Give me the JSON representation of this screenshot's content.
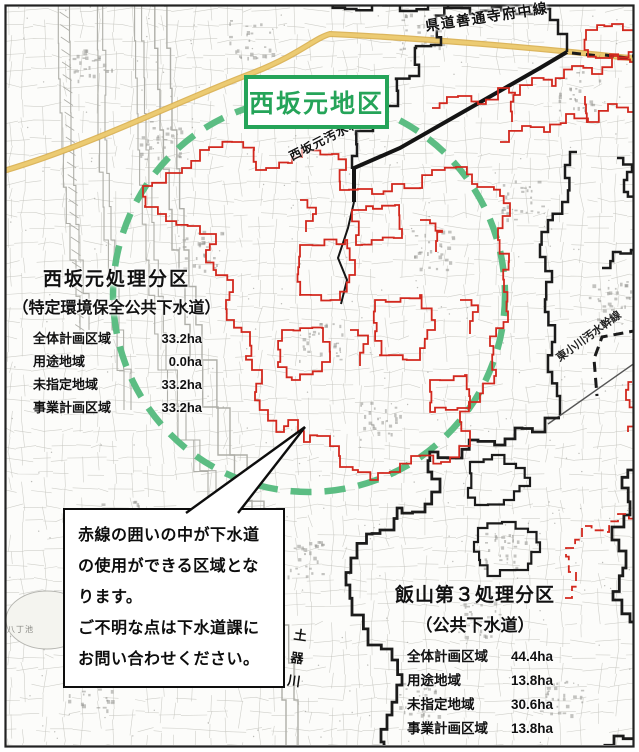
{
  "title_box": {
    "label": "西坂元地区"
  },
  "labels": {
    "road_top": "県道善通寺府中線",
    "trunk_sewer": "西坂元汚水幹線",
    "east_trunk": "東小川汚水幹線",
    "river": "土器川",
    "pond": "八丁池"
  },
  "district_west": {
    "title": "西坂元処理分区",
    "subtitle": "（特定環境保全公共下水道）",
    "rows": [
      {
        "label": "全体計画区域",
        "value": "33.2ha"
      },
      {
        "label": "用途地域",
        "value": "0.0ha"
      },
      {
        "label": "未指定地域",
        "value": "33.2ha"
      },
      {
        "label": "事業計画区域",
        "value": "33.2ha"
      }
    ]
  },
  "district_iiyama": {
    "title": "飯山第３処理分区",
    "subtitle": "（公共下水道）",
    "rows": [
      {
        "label": "全体計画区域",
        "value": "44.4ha"
      },
      {
        "label": "用途地域",
        "value": "13.8ha"
      },
      {
        "label": "未指定地域",
        "value": "30.6ha"
      },
      {
        "label": "事業計画区域",
        "value": "13.8ha"
      }
    ]
  },
  "callout": {
    "lines": [
      "赤線の囲いの中が下水道",
      "の使用ができる区域とな",
      "ります。",
      "ご不明な点は下水道課に",
      "お問い合わせください。"
    ]
  },
  "colors": {
    "red_boundary": "#d2281e",
    "green_accent": "#25a459",
    "green_dashed": "#5cbd83",
    "yellow_road": "#e9c766",
    "boundary_black": "#1b1b1b"
  }
}
